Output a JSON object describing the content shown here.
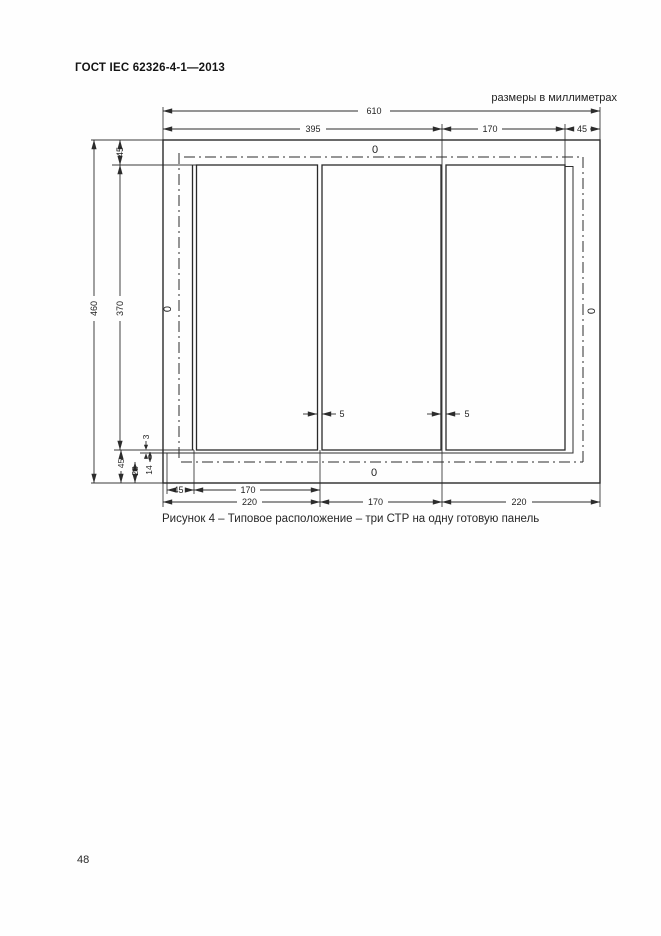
{
  "page": {
    "header_title": "ГОСТ IEC 62326-4-1—2013",
    "units_note": "размеры в миллиметрах",
    "page_number": "48"
  },
  "figure": {
    "caption": "Рисунок 4 – Типовое расположение – три СТР на одну готовую панель",
    "panels_count": 3,
    "dims": {
      "total_width": "610",
      "top_395": "395",
      "top_170": "170",
      "top_45": "45",
      "left_460": "460",
      "left_45": "45",
      "left_370": "370",
      "bl_3": "3",
      "bl_45": "45",
      "bl_28": "28",
      "bl_14": "14",
      "gap1_5": "5",
      "gap2_5": "5",
      "ba_45": "45",
      "ba_170": "170",
      "bb_220l": "220",
      "bb_170": "170",
      "bb_220r": "220",
      "zero_top": "0",
      "zero_left": "0",
      "zero_right": "0",
      "zero_bottom": "0"
    }
  }
}
